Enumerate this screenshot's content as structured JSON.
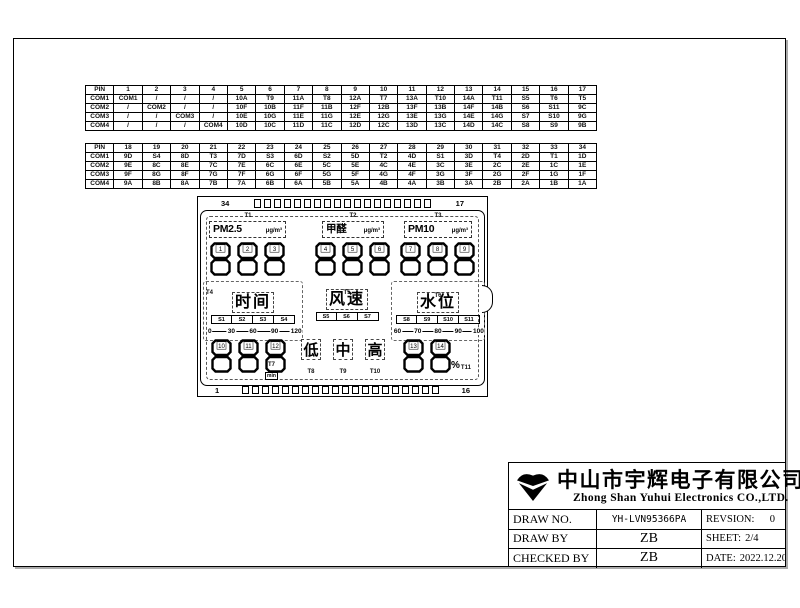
{
  "pin_tables": [
    {
      "header": [
        "PIN",
        "1",
        "2",
        "3",
        "4",
        "5",
        "6",
        "7",
        "8",
        "9",
        "10",
        "11",
        "12",
        "13",
        "14",
        "15",
        "16",
        "17"
      ],
      "rows": [
        [
          "COM1",
          "COM1",
          "/",
          "/",
          "/",
          "10A",
          "T9",
          "11A",
          "T8",
          "12A",
          "T7",
          "13A",
          "T10",
          "14A",
          "T11",
          "S5",
          "T6",
          "T5"
        ],
        [
          "COM2",
          "/",
          "COM2",
          "/",
          "/",
          "10F",
          "10B",
          "11F",
          "11B",
          "12F",
          "12B",
          "13F",
          "13B",
          "14F",
          "14B",
          "S6",
          "S11",
          "9C"
        ],
        [
          "COM3",
          "/",
          "/",
          "COM3",
          "/",
          "10E",
          "10G",
          "11E",
          "11G",
          "12E",
          "12G",
          "13E",
          "13G",
          "14E",
          "14G",
          "S7",
          "S10",
          "9G"
        ],
        [
          "COM4",
          "/",
          "/",
          "/",
          "COM4",
          "10D",
          "10C",
          "11D",
          "11C",
          "12D",
          "12C",
          "13D",
          "13C",
          "14D",
          "14C",
          "S8",
          "S9",
          "9B"
        ]
      ]
    },
    {
      "header": [
        "PIN",
        "18",
        "19",
        "20",
        "21",
        "22",
        "23",
        "24",
        "25",
        "26",
        "27",
        "28",
        "29",
        "30",
        "31",
        "32",
        "33",
        "34"
      ],
      "rows": [
        [
          "COM1",
          "9D",
          "S4",
          "8D",
          "T3",
          "7D",
          "S3",
          "6D",
          "S2",
          "5D",
          "T2",
          "4D",
          "S1",
          "3D",
          "T4",
          "2D",
          "T1",
          "1D"
        ],
        [
          "COM2",
          "9E",
          "8C",
          "8E",
          "7C",
          "7E",
          "6C",
          "6E",
          "5C",
          "5E",
          "4C",
          "4E",
          "3C",
          "3E",
          "2C",
          "2E",
          "1C",
          "1E"
        ],
        [
          "COM3",
          "9F",
          "8G",
          "8F",
          "7G",
          "7F",
          "6G",
          "6F",
          "5G",
          "5F",
          "4G",
          "4F",
          "3G",
          "3F",
          "2G",
          "2F",
          "1G",
          "1F"
        ],
        [
          "COM4",
          "9A",
          "8B",
          "8A",
          "7B",
          "7A",
          "6B",
          "6A",
          "5B",
          "5A",
          "4B",
          "4A",
          "3B",
          "3A",
          "2B",
          "2A",
          "1B",
          "1A"
        ]
      ]
    }
  ],
  "lcd": {
    "top_left_pin": "34",
    "top_right_pin": "17",
    "bottom_left_pin": "1",
    "bottom_right_pin": "16",
    "panels": [
      {
        "tag": "T1",
        "name": "PM2.5",
        "unit": "μg/m³"
      },
      {
        "tag": "T2",
        "name": "甲醛",
        "unit": "μg/m³"
      },
      {
        "tag": "T3",
        "name": "PM10",
        "unit": "μg/m³"
      }
    ],
    "digit_groups": [
      [
        "1",
        "2",
        "3"
      ],
      [
        "4",
        "5",
        "6"
      ],
      [
        "7",
        "8",
        "9"
      ],
      [
        "10",
        "11",
        "12"
      ],
      [
        "13",
        "14"
      ]
    ],
    "bars": [
      {
        "tag": "T4",
        "title": "时间",
        "segments": [
          "S1",
          "S2",
          "S3",
          "S4"
        ],
        "scale": [
          "0",
          "30",
          "60",
          "90",
          "120"
        ]
      },
      {
        "tag": "T5",
        "title": "风速",
        "segments": [
          "S5",
          "S6",
          "S7"
        ],
        "scale": []
      },
      {
        "tag": "T6",
        "title": "水位",
        "segments": [
          "S8",
          "S9",
          "S10",
          "S11"
        ],
        "scale": [
          "60",
          "70",
          "80",
          "90",
          "100"
        ]
      }
    ],
    "min_marker": {
      "tag": "T7",
      "text": "min"
    },
    "status_icons": [
      {
        "tag": "T8",
        "char": "低"
      },
      {
        "tag": "T9",
        "char": "中"
      },
      {
        "tag": "T10",
        "char": "高"
      }
    ],
    "percent_marker": {
      "tag": "T11",
      "char": "%"
    }
  },
  "title_block": {
    "company_cn": "中山市宇辉电子有限公司",
    "company_en": "Zhong Shan Yuhui Electronics CO.,LTD.",
    "draw_no_label": "DRAW NO.",
    "draw_no": "YH-LVN95366PA",
    "revision_label": "REVSION:",
    "revision": "0",
    "draw_by_label": "DRAW BY",
    "draw_by": "ZB",
    "sheet_label": "SHEET:",
    "sheet": "2/4",
    "checked_by_label": "CHECKED BY",
    "checked_by": "ZB",
    "date_label": "DATE:",
    "date": "2022.12.20"
  }
}
